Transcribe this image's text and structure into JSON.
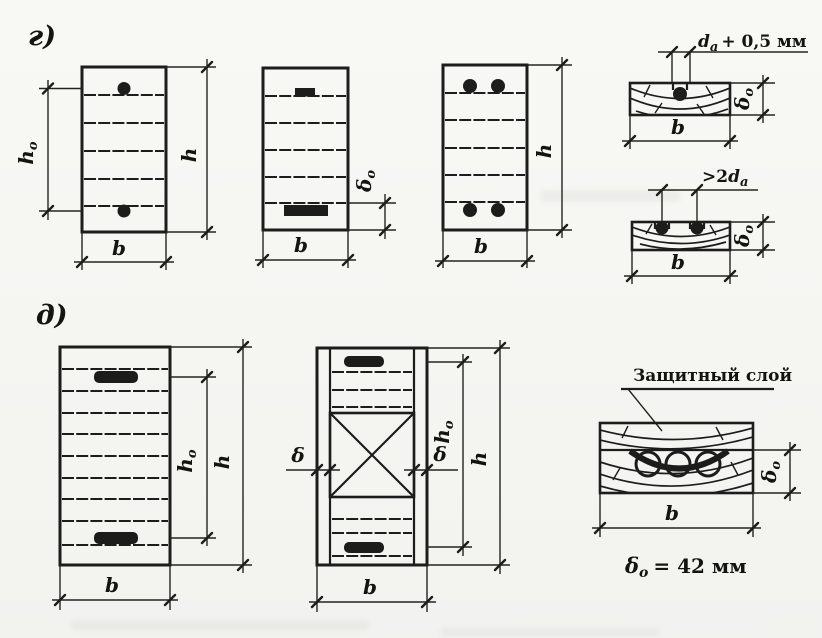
{
  "colors": {
    "paper": "#fbfbf8",
    "ink": "#1d1d1b"
  },
  "sections": {
    "top": {
      "label": "г)"
    },
    "bottom": {
      "label": "д)"
    }
  },
  "dims": {
    "b": "b",
    "h": "h",
    "h0": {
      "base": "h",
      "sub": "o"
    },
    "delta": "δ",
    "delta0": {
      "base": "δ",
      "sub": "o"
    }
  },
  "notes": {
    "groove_width": {
      "base": "d",
      "sub": "a",
      "rest": "+ 0,5 мм"
    },
    "bar_spacing": {
      "pre": ">2",
      "base": "d",
      "sub": "a"
    },
    "protective_layer": "Защитный слой",
    "cover_value": {
      "base": "δ",
      "sub": "o",
      "rest": "= 42 мм"
    }
  }
}
